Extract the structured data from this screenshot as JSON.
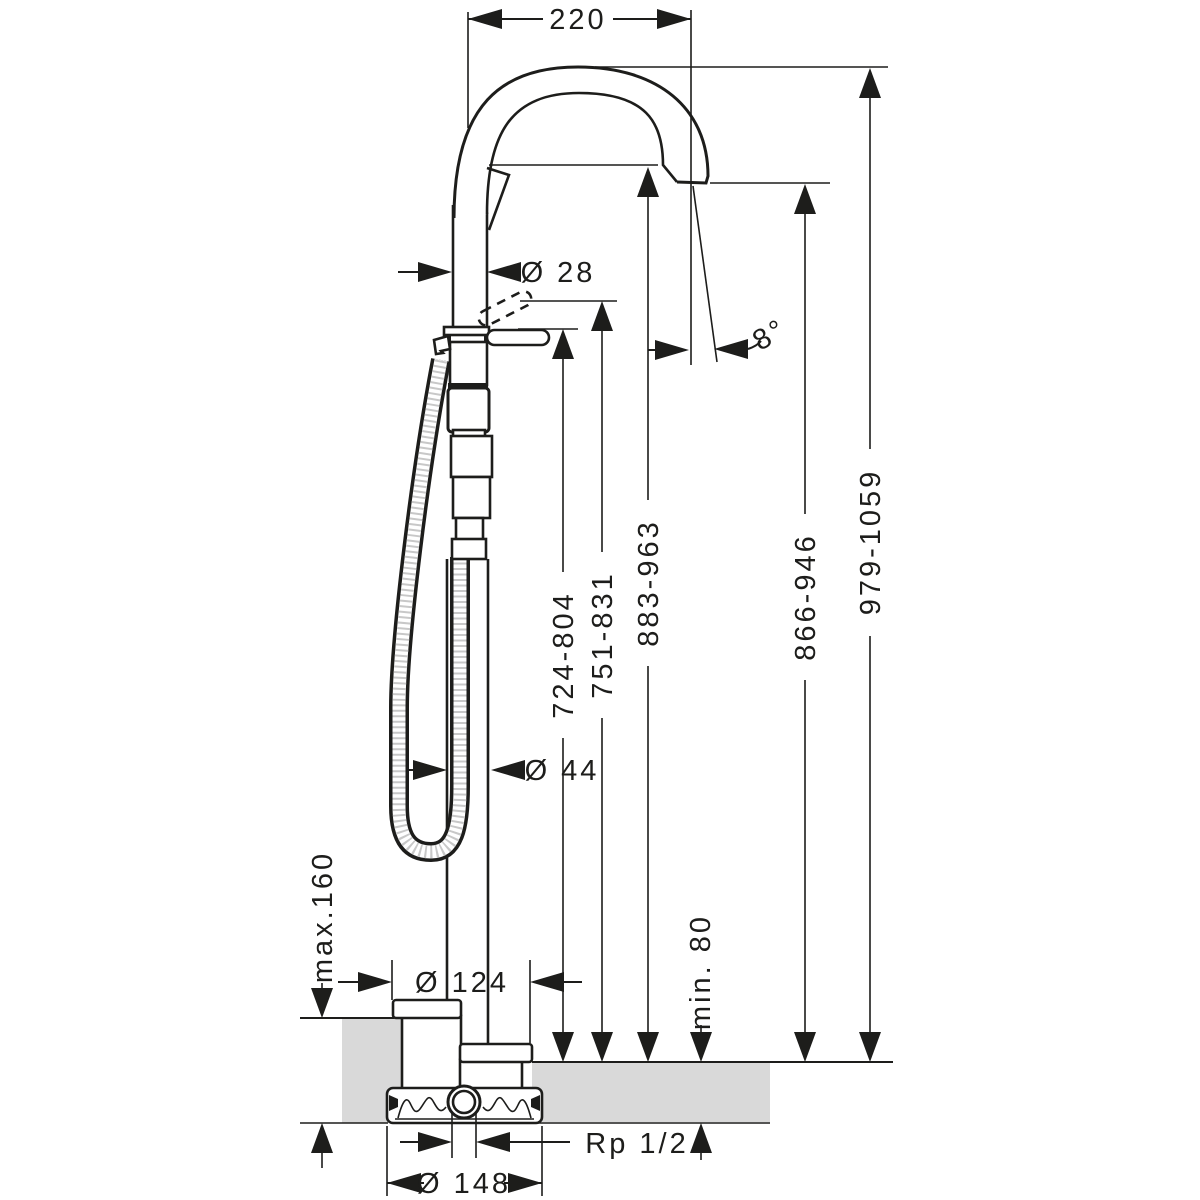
{
  "drawing": {
    "type": "technical-dimension-drawing",
    "subject": "freestanding-bath-mixer-with-handshower",
    "colors": {
      "ink": "#1d1d1b",
      "floor_fill": "#d9d9d9",
      "background": "#ffffff"
    },
    "labels": {
      "spout_reach": "220",
      "pipe_diameter": "Ø 28",
      "spout_angle": "8°",
      "height_lever": "724-804",
      "height_lever_raised": "751-831",
      "height_outlet": "883-963",
      "height_outlet_tip": "866-946",
      "height_total": "979-1059",
      "column_diameter": "Ø 44",
      "base_plate_diameter": "Ø 124",
      "floor_buildup_max": "max.160",
      "floor_depth_min": "min. 80",
      "connection_thread": "Rp 1/2",
      "installation_body_diameter": "Ø 148"
    }
  }
}
